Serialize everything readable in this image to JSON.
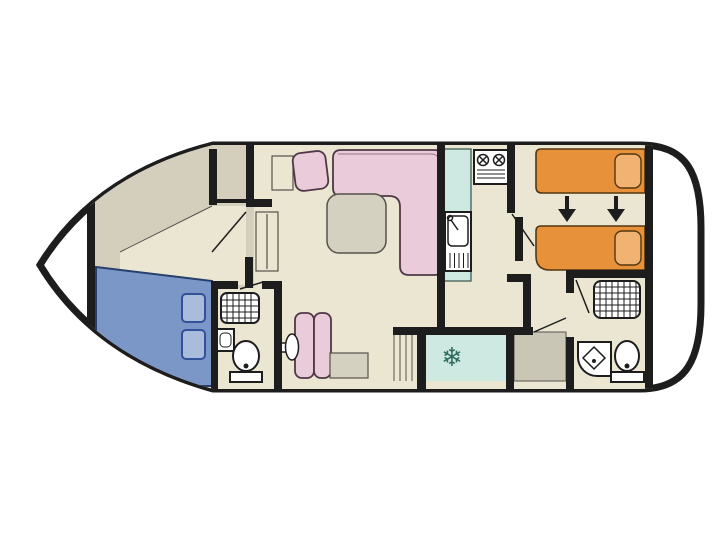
{
  "palette": {
    "background": "#ffffff",
    "outline": "#1d1d1d",
    "floor": "#ebe6d2",
    "floor_shaded": "#d3cfbc",
    "furniture_grey": "#d5d1c1",
    "hatch_grey": "#cac6b6",
    "detail_line": "#55524a",
    "bed_blue": "#7b97c8",
    "bed_blue_outline": "#27406b",
    "pillow_blue": "#a9bcdb",
    "pillow_blue_outline": "#31529b",
    "sofa_pink": "#e9cbda",
    "sofa_outline": "#4f3747",
    "bed_orange": "#e8913b",
    "bed_orange_outline": "#54360e",
    "pillow_orange": "#f2b271",
    "counter_teal": "#cde9e1",
    "teal_outline": "#35504a",
    "fixture_white": "#ffffff",
    "snowflake_teal": "#2d6b5e"
  },
  "glyphs": {
    "snowflake": "❄"
  }
}
